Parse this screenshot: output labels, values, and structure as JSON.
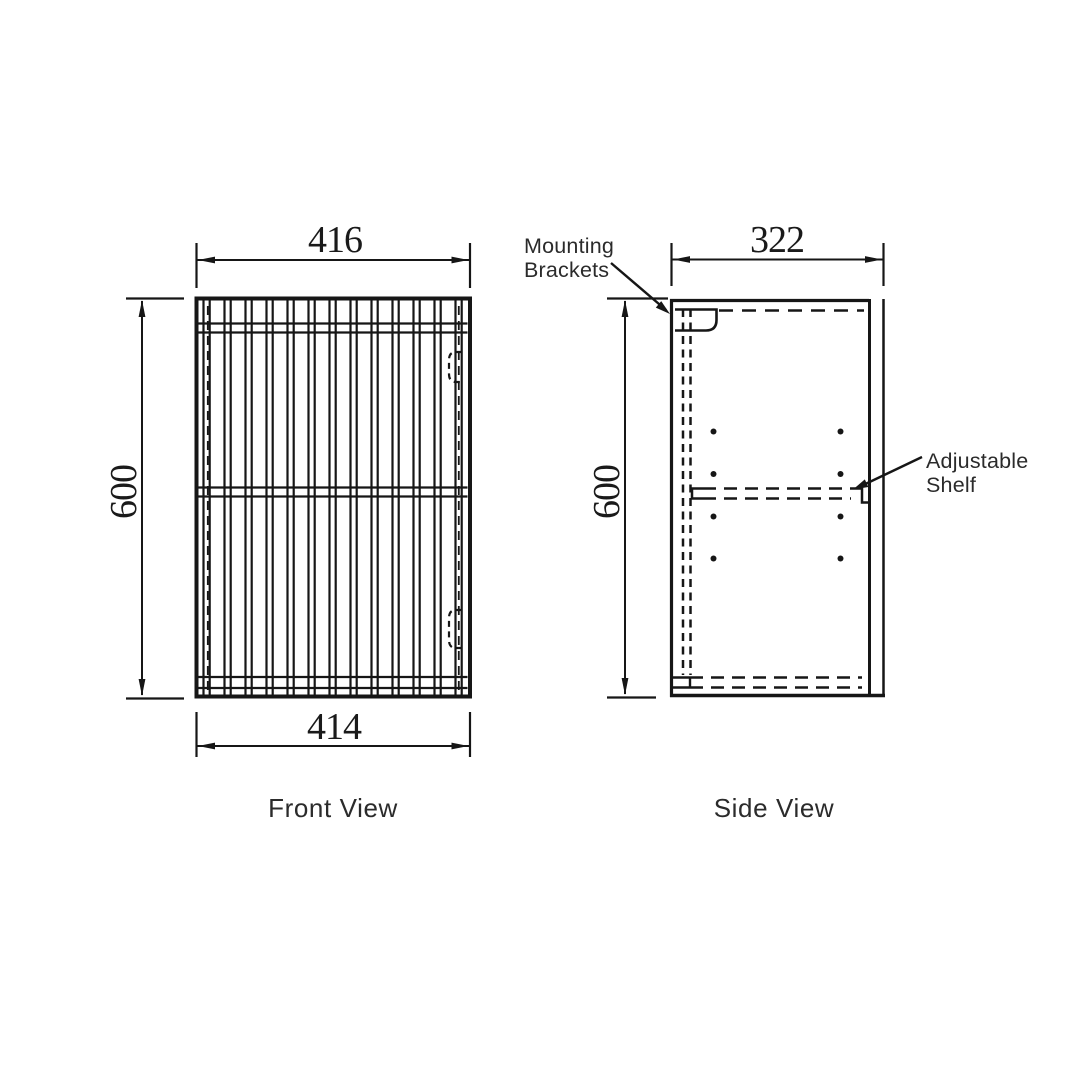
{
  "drawing": {
    "background": "#ffffff",
    "line_color": "#161616",
    "labels": {
      "front_view": "Front View",
      "side_view": "Side View"
    },
    "annotations": {
      "mounting": {
        "line1": "Mounting",
        "line2": "Brackets"
      },
      "shelf": {
        "line1": "Adjustable",
        "line2": "Shelf"
      }
    },
    "dimensions": {
      "front_width_top": "416",
      "front_width_bottom": "414",
      "front_height": "600",
      "side_depth": "322",
      "side_height": "600"
    }
  },
  "geometry": {
    "stroke": "#161616",
    "rects": [
      {
        "name": "front-panel-outline",
        "x": 196.5,
        "y": 298.5,
        "w": 273.5,
        "h": 398,
        "sw": 4
      }
    ],
    "solid_lines": [
      {
        "name": "ext-line-416-left",
        "x1": 196.5,
        "y1": 243,
        "x2": 196.5,
        "y2": 288,
        "w": 2.2
      },
      {
        "name": "ext-line-416-right",
        "x1": 470,
        "y1": 243,
        "x2": 470,
        "y2": 288,
        "w": 2.2
      },
      {
        "name": "dim-line-416",
        "x1": 196.5,
        "y1": 260,
        "x2": 470,
        "y2": 260,
        "w": 2
      },
      {
        "name": "ext-line-414-left",
        "x1": 196.5,
        "y1": 712,
        "x2": 196.5,
        "y2": 757,
        "w": 2.2
      },
      {
        "name": "ext-line-414-right",
        "x1": 470,
        "y1": 712,
        "x2": 470,
        "y2": 757,
        "w": 2.2
      },
      {
        "name": "dim-line-414",
        "x1": 196.5,
        "y1": 746,
        "x2": 470,
        "y2": 746,
        "w": 2
      },
      {
        "name": "ext-line-600f-top",
        "x1": 126,
        "y1": 298.5,
        "x2": 184,
        "y2": 298.5,
        "w": 2.2
      },
      {
        "name": "ext-line-600f-bottom",
        "x1": 126,
        "y1": 698.5,
        "x2": 184,
        "y2": 698.5,
        "w": 2.2
      },
      {
        "name": "dim-line-600f",
        "x1": 142,
        "y1": 301,
        "x2": 142,
        "y2": 695,
        "w": 2
      },
      {
        "name": "side-left-edge",
        "x1": 671.5,
        "y1": 299,
        "x2": 671.5,
        "y2": 697,
        "w": 3.2
      },
      {
        "name": "side-top-edge",
        "x1": 670,
        "y1": 300.5,
        "x2": 869,
        "y2": 300.5,
        "w": 3.2
      },
      {
        "name": "side-bottom-edge",
        "x1": 670,
        "y1": 695.5,
        "x2": 885,
        "y2": 695.5,
        "w": 3.5
      },
      {
        "name": "door-inner-line",
        "x1": 869.5,
        "y1": 299,
        "x2": 869.5,
        "y2": 697,
        "w": 3
      },
      {
        "name": "door-outer-line",
        "x1": 883.5,
        "y1": 299,
        "x2": 883.5,
        "y2": 697,
        "w": 2.5
      },
      {
        "name": "bottom-panel-stub-a",
        "x1": 672,
        "y1": 677.5,
        "x2": 690,
        "y2": 677.5,
        "w": 2.4
      },
      {
        "name": "bottom-panel-stub-b",
        "x1": 672,
        "y1": 687.5,
        "x2": 690,
        "y2": 687.5,
        "w": 2.4
      },
      {
        "name": "bottom-panel-step",
        "x1": 690,
        "y1": 677.5,
        "x2": 690,
        "y2": 687.5,
        "w": 2.4
      },
      {
        "name": "ext-line-322-left",
        "x1": 671.5,
        "y1": 243,
        "x2": 671.5,
        "y2": 286,
        "w": 2.2
      },
      {
        "name": "ext-line-322-right",
        "x1": 883.5,
        "y1": 243,
        "x2": 883.5,
        "y2": 286,
        "w": 2.2
      },
      {
        "name": "dim-line-322",
        "x1": 671.5,
        "y1": 259.5,
        "x2": 883.5,
        "y2": 259.5,
        "w": 2
      },
      {
        "name": "ext-line-600s-top",
        "x1": 607,
        "y1": 298.5,
        "x2": 668,
        "y2": 298.5,
        "w": 2.2
      },
      {
        "name": "ext-line-600s-bottom",
        "x1": 607,
        "y1": 697.5,
        "x2": 656,
        "y2": 697.5,
        "w": 2.2
      },
      {
        "name": "dim-line-600s",
        "x1": 625,
        "y1": 301,
        "x2": 625,
        "y2": 694,
        "w": 2
      },
      {
        "name": "mounting-leader-line",
        "x1": 611,
        "y1": 263,
        "x2": 666,
        "y2": 310,
        "w": 2.4
      },
      {
        "name": "shelf-leader-line",
        "x1": 922,
        "y1": 457,
        "x2": 857,
        "y2": 488,
        "w": 2.4
      }
    ],
    "paths": [
      {
        "name": "mounting-bracket",
        "d": "M 675 330.5 L 706 330.5 Q 716.5 330.5 716.5 320 L 716.5 309.5 L 675 309.5",
        "w": 2.6
      },
      {
        "name": "shelf-left-cap",
        "d": "M 703 488.5 L 692 488.5 L 692 498.5 L 703 498.5",
        "w": 2.5
      },
      {
        "name": "shelf-right-step",
        "d": "M 851 488.5 L 862 488.5 L 862 502.5 L 869 502.5",
        "w": 2.5
      },
      {
        "name": "hinge-hidden-top",
        "d": "M 462 352 L 456 352 Q 449 352 449 360 L 449 374 Q 449 382 456 382 L 462 382",
        "w": 2.2,
        "dash": "6 4.5"
      },
      {
        "name": "hinge-hidden-bottom",
        "d": "M 462 610 L 456 610 Q 449 610 449 618 L 449 640 Q 449 648 456 648 L 462 648",
        "w": 2.2,
        "dash": "6 4.5"
      }
    ],
    "dashed_lines": [
      {
        "name": "side-top-hidden",
        "x1": 719,
        "y1": 310.5,
        "x2": 864,
        "y2": 310.5,
        "w": 2.5,
        "dash": "14 9"
      },
      {
        "name": "back-panel-hidden-a",
        "x1": 683,
        "y1": 309,
        "x2": 683,
        "y2": 675,
        "w": 2.5,
        "dash": "8 5.5"
      },
      {
        "name": "back-panel-hidden-b",
        "x1": 690.5,
        "y1": 309,
        "x2": 690.5,
        "y2": 675,
        "w": 2.5,
        "dash": "8 5.5"
      },
      {
        "name": "shelf-hidden-a",
        "x1": 703,
        "y1": 488.5,
        "x2": 851,
        "y2": 488.5,
        "w": 2.5,
        "dash": "13 8"
      },
      {
        "name": "shelf-hidden-b",
        "x1": 703,
        "y1": 498.5,
        "x2": 851,
        "y2": 498.5,
        "w": 2.5,
        "dash": "13 8"
      },
      {
        "name": "bottom-hidden-a",
        "x1": 690,
        "y1": 677.5,
        "x2": 862,
        "y2": 677.5,
        "w": 2.5,
        "dash": "13 8"
      },
      {
        "name": "bottom-hidden-b",
        "x1": 690,
        "y1": 687.5,
        "x2": 862,
        "y2": 687.5,
        "w": 2.5,
        "dash": "13 8"
      },
      {
        "name": "front-hidden-left",
        "x1": 207.8,
        "y1": 306,
        "x2": 207.8,
        "y2": 691,
        "w": 1.8,
        "dash": "9 6"
      },
      {
        "name": "front-hidden-right",
        "x1": 458.8,
        "y1": 306,
        "x2": 458.8,
        "y2": 691,
        "w": 1.8,
        "dash": "9 6"
      }
    ],
    "slats": {
      "x_start": 203.5,
      "count": 13,
      "period": 21,
      "pair_gap": 6.2,
      "line_w": 2.2,
      "y_top": 300.5,
      "y_bottom": 694.5
    },
    "rails": {
      "x1": 198.5,
      "x2": 467.5,
      "line_w": 2.2,
      "ys": [
        323.5,
        332.5,
        487.5,
        496.5,
        677,
        688
      ]
    },
    "dots": [
      {
        "name": "shelf-pin-hole",
        "x": 713.5,
        "y": 431.5,
        "r": 3
      },
      {
        "name": "shelf-pin-hole",
        "x": 840.5,
        "y": 431.5,
        "r": 3
      },
      {
        "name": "shelf-pin-hole",
        "x": 713.5,
        "y": 474,
        "r": 3
      },
      {
        "name": "shelf-pin-hole",
        "x": 840.5,
        "y": 474,
        "r": 3
      },
      {
        "name": "shelf-pin-hole",
        "x": 713.5,
        "y": 516.5,
        "r": 3
      },
      {
        "name": "shelf-pin-hole",
        "x": 840.5,
        "y": 516.5,
        "r": 3
      },
      {
        "name": "shelf-pin-hole",
        "x": 713.5,
        "y": 558.5,
        "r": 3
      },
      {
        "name": "shelf-pin-hole",
        "x": 840.5,
        "y": 558.5,
        "r": 3
      }
    ],
    "arrows": [
      {
        "name": "arrow-416-left",
        "x": 198,
        "y": 260,
        "a": 180
      },
      {
        "name": "arrow-416-right",
        "x": 468.5,
        "y": 260,
        "a": 0
      },
      {
        "name": "arrow-414-left",
        "x": 198,
        "y": 746,
        "a": 180
      },
      {
        "name": "arrow-414-right",
        "x": 468.5,
        "y": 746,
        "a": 0
      },
      {
        "name": "arrow-600f-top",
        "x": 142,
        "y": 300,
        "a": -90
      },
      {
        "name": "arrow-600f-bottom",
        "x": 142,
        "y": 696,
        "a": 90
      },
      {
        "name": "arrow-322-left",
        "x": 673,
        "y": 259.5,
        "a": 180
      },
      {
        "name": "arrow-322-right",
        "x": 882,
        "y": 259.5,
        "a": 0
      },
      {
        "name": "arrow-600s-top",
        "x": 625,
        "y": 300,
        "a": -90
      },
      {
        "name": "arrow-600s-bottom",
        "x": 625,
        "y": 695,
        "a": 90
      },
      {
        "name": "arrow-mounting-leader",
        "x": 670,
        "y": 314,
        "a": 40,
        "len": 15,
        "hw": 4.2
      },
      {
        "name": "arrow-shelf-leader",
        "x": 853,
        "y": 489.5,
        "a": 155,
        "len": 15,
        "hw": 4.2
      }
    ]
  }
}
